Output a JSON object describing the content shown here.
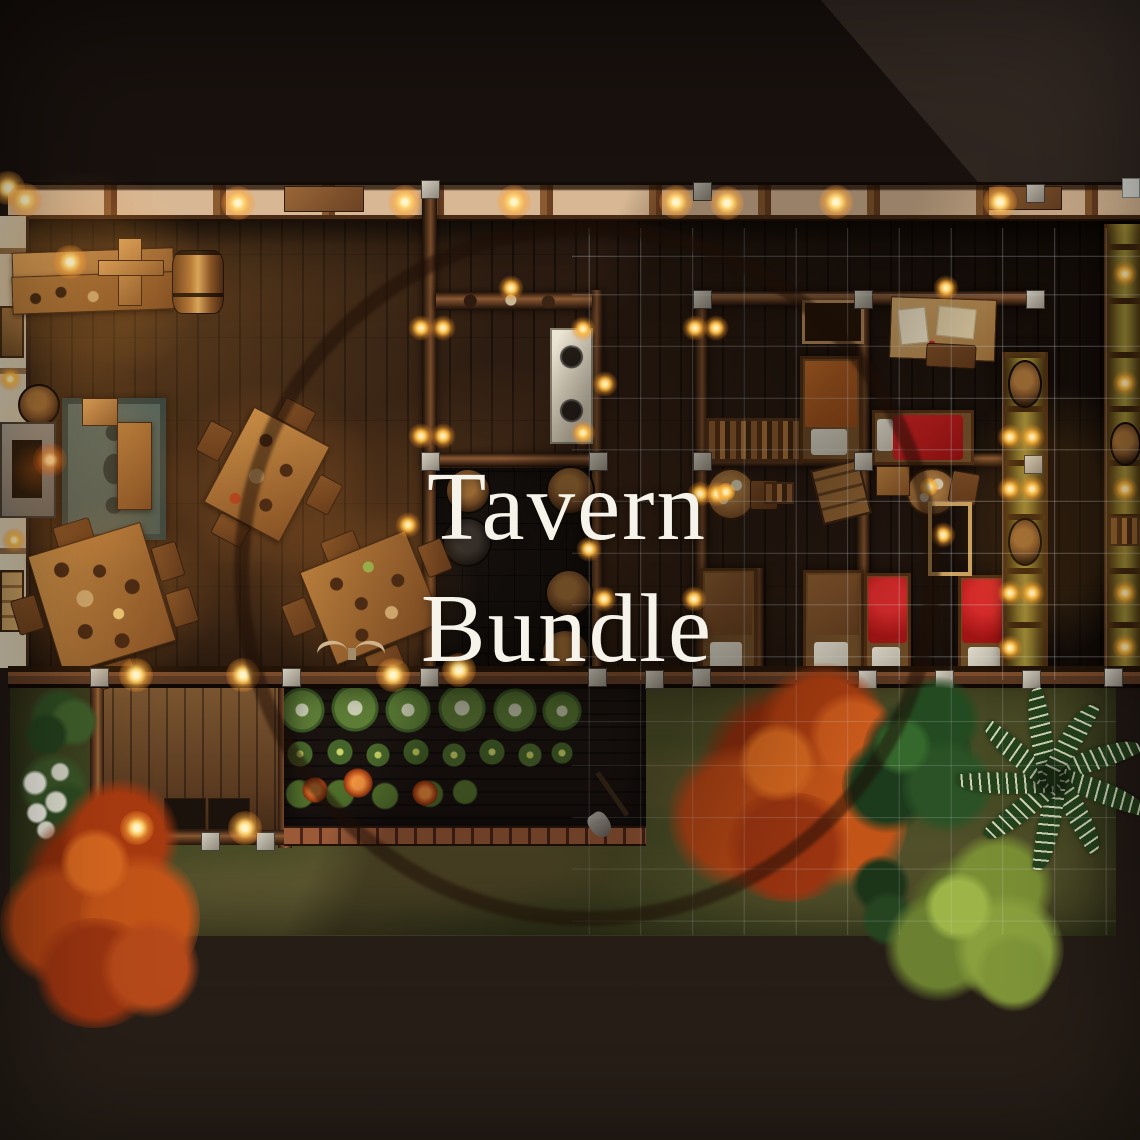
{
  "title": {
    "line1": "Tavern",
    "line2": "Bundle"
  },
  "watermark": {
    "shape": "circle-ring"
  },
  "palette": {
    "background": "#1b1310",
    "background_wedge": "#342a24",
    "floor_wood": "#2e1d12",
    "roof_panel": "#d8b894",
    "beam_wood": "#6b3f22",
    "plaster_wall": "#e2d6bc",
    "furniture_wood": "#b07a3c",
    "rug": "#5a6b64",
    "stone": "#a39e94",
    "stove": "#efe7d6",
    "bed_red": "#b01c1c",
    "bed_orange": "#a8551e",
    "bed_brown": "#7a4a26",
    "pillow": "#ded9cb",
    "grass": "#474c25",
    "soil": "#1c1511",
    "brick_path": "#9a5a38",
    "tree_red": "#c25418",
    "tree_green_dark": "#2a5226",
    "tree_green_light": "#8aa03e",
    "striped_plant": "#24421c",
    "light_glow": "#ffd36e",
    "grid_line": "#d7dce1",
    "watermark_ring": "#1c0e06",
    "title_text": "#f6f3ea"
  }
}
